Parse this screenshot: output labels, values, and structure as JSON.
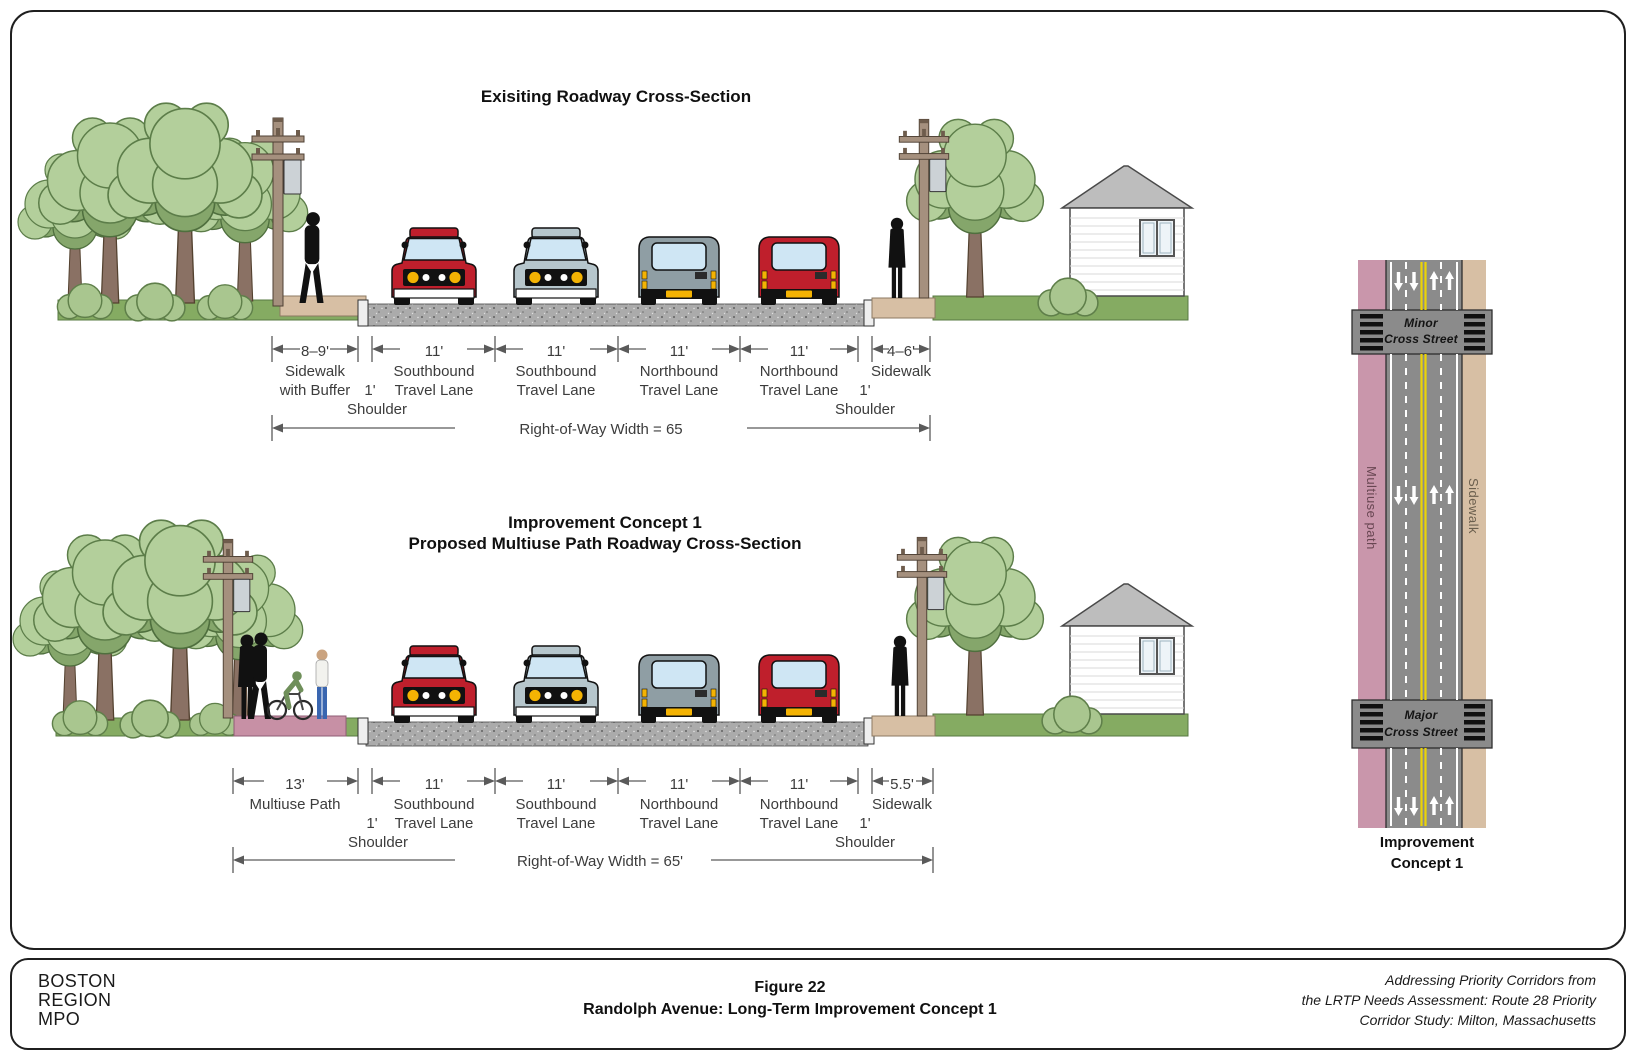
{
  "existing": {
    "title": "Exisiting Roadway Cross-Section",
    "segments": [
      {
        "width": "8–9'",
        "label1": "Sidewalk",
        "label2": "with Buffer"
      },
      {
        "width": "11'",
        "label1": "Southbound",
        "label2": "Travel Lane"
      },
      {
        "width": "11'",
        "label1": "Southbound",
        "label2": "Travel Lane"
      },
      {
        "width": "11'",
        "label1": "Northbound",
        "label2": "Travel Lane"
      },
      {
        "width": "11'",
        "label1": "Northbound",
        "label2": "Travel Lane"
      },
      {
        "width": "4–6'",
        "label1": "Sidewalk"
      }
    ],
    "shoulder_left": {
      "width": "1'",
      "label": "Shoulder"
    },
    "shoulder_right": {
      "width": "1'",
      "label": "Shoulder"
    },
    "right_of_way": "Right-of-Way Width = 65"
  },
  "concept1": {
    "title_line1": "Improvement Concept 1",
    "title_line2": "Proposed Multiuse Path Roadway Cross-Section",
    "segments": [
      {
        "width": "13'",
        "label1": "Multiuse Path"
      },
      {
        "width": "11'",
        "label1": "Southbound",
        "label2": "Travel Lane"
      },
      {
        "width": "11'",
        "label1": "Southbound",
        "label2": "Travel Lane"
      },
      {
        "width": "11'",
        "label1": "Northbound",
        "label2": "Travel Lane"
      },
      {
        "width": "11'",
        "label1": "Northbound",
        "label2": "Travel Lane"
      },
      {
        "width": "5.5'",
        "label1": "Sidewalk"
      }
    ],
    "shoulder_left": {
      "width": "1'",
      "label": "Shoulder"
    },
    "shoulder_right": {
      "width": "1'",
      "label": "Shoulder"
    },
    "right_of_way": "Right-of-Way Width = 65'"
  },
  "plan": {
    "minor_street_line1": "Minor",
    "minor_street_line2": "Cross Street",
    "major_street_line1": "Major",
    "major_street_line2": "Cross Street",
    "left_strip_label": "Multiuse path",
    "right_strip_label": "Sidewalk",
    "caption_line1": "Improvement",
    "caption_line2": "Concept 1"
  },
  "footer": {
    "org_line1": "BOSTON",
    "org_line2": "REGION",
    "org_line3": "MPO",
    "figure_label": "Figure 22",
    "figure_title": "Randolph Avenue: Long-Term Improvement Concept 1",
    "citation_line1": "Addressing Priority Corridors from",
    "citation_line2": "the LRTP Needs Assessment: Route 28 Priority",
    "citation_line3": "Corridor Study: Milton, Massachusetts"
  },
  "colors": {
    "road_gray": "#8b8b8b",
    "asphalt": "#ababab",
    "multiuse_pink": "#c790a5",
    "sidewalk_tan": "#d7bfa4",
    "grass_green": "#85ab62",
    "foliage_green": "#b3cf9b",
    "car_red": "#bf1f2c",
    "car_gray": "#b6c6cc",
    "lane_yellow": "#ecd405"
  }
}
